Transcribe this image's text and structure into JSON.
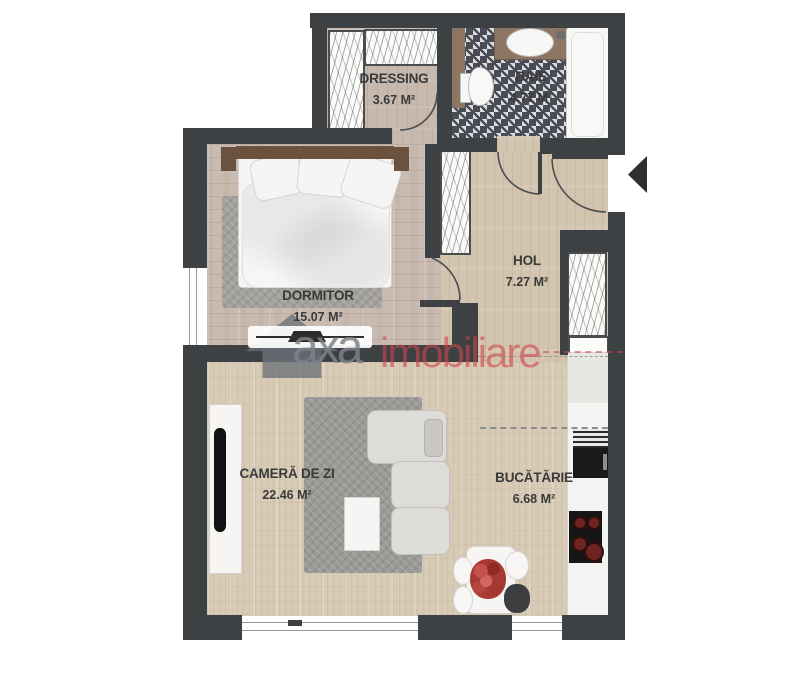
{
  "title": "Apartment floor plan",
  "rooms": [
    {
      "name": "DRESSING",
      "area": "3.67 M²"
    },
    {
      "name": "BAIE",
      "area": "4.77 M²"
    },
    {
      "name": "HOL",
      "area": "7.27 M²"
    },
    {
      "name": "DORMITOR",
      "area": "15.07 M²"
    },
    {
      "name": "CAMERĂ DE ZI",
      "area": "22.46 M²"
    },
    {
      "name": "BUCĂTĂRIE",
      "area": "6.68 M²"
    }
  ],
  "watermark": {
    "brand_gray": "axa",
    "brand_red": "imobiliare"
  },
  "colors": {
    "wall": "#3e4144",
    "accent_red": "#ce444c",
    "floor_wood_light": "#d8cbb5",
    "floor_wood_warm": "#c9bbb1",
    "tile_dark": "#494b55"
  }
}
